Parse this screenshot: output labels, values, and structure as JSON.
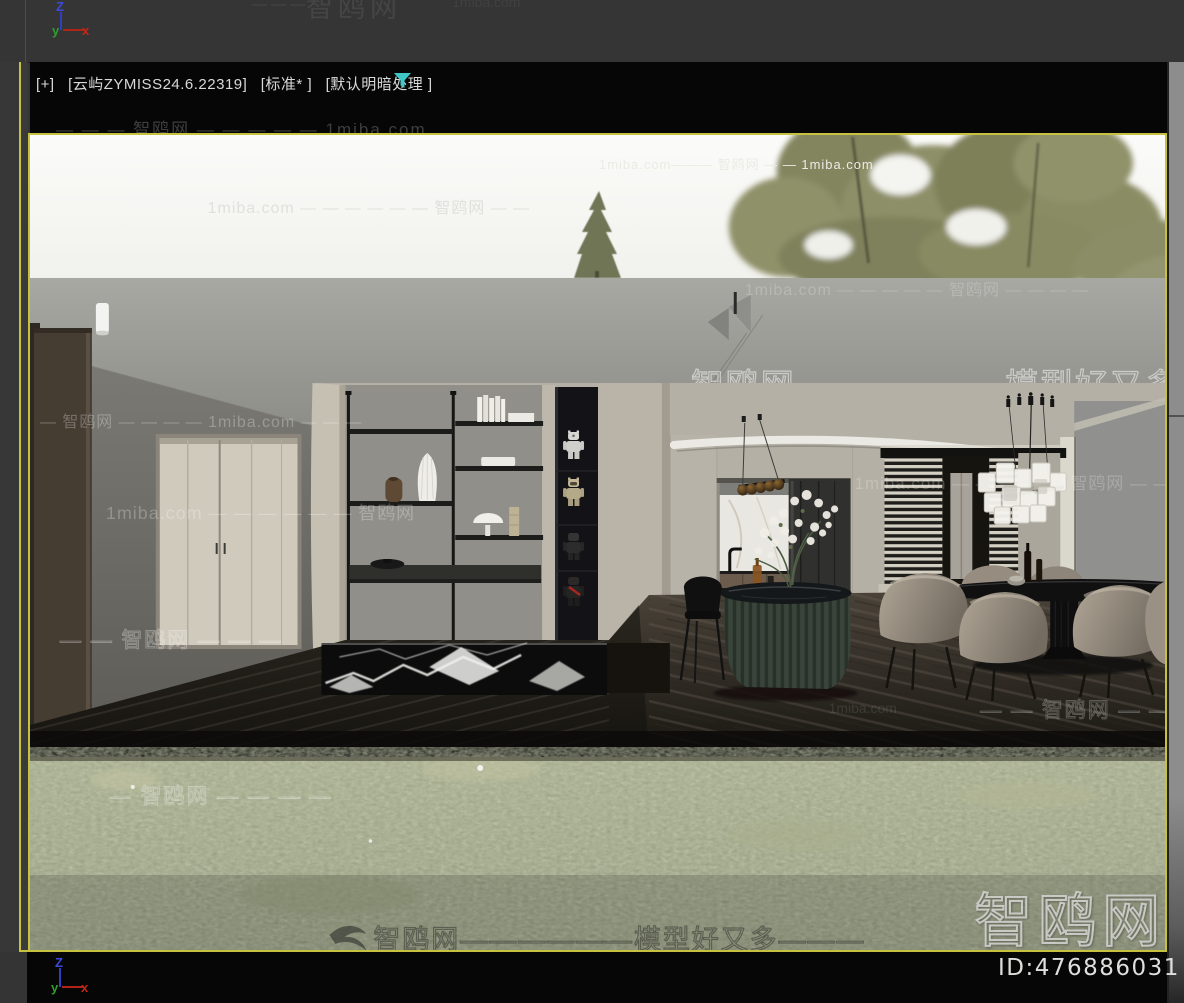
{
  "chrome": {
    "viewport_label": {
      "pov": "[+]",
      "name": "[云屿ZYMISS24.6.22319]",
      "style": "[标准* ]",
      "shading": "[默认明暗处理 ]"
    },
    "id_badge": "ID:476886031",
    "accent_border": "#c8c341",
    "filter_icon_color": "#3fc6c6",
    "top_axis": {
      "z": "Z",
      "y": "y",
      "x": "x"
    },
    "bottom_axis": {
      "z": "Z",
      "y": "y",
      "x": "x"
    },
    "axis_colors": {
      "z": "#4053e0",
      "y": "#3fae3f",
      "x": "#c23a2e"
    }
  },
  "watermarks": {
    "top_partial": "智鸥网",
    "top_dashes": "— — —",
    "top_site": "1miba.com",
    "bar": "— — — 智鸥网 — — — — — 1miba.com",
    "sky1": "1miba.com — — — — — — 智鸥网 — —",
    "sky2": "1miba.com——— 智鸥网 — — 1miba.com",
    "ceiling_right": "1miba.com — — — — — 智鸥网 — — — —",
    "ceiling_big": "智鸥网——————模型好又多———",
    "wall_left_1": "— 智鸥网 — — — — 1miba.com — — —",
    "wall_left_2": "1miba.com — — — — — — 智鸥网",
    "wall_left_3": "— — 智鸥网 — — —",
    "wall_right": "1miba.com — — — — — 智鸥网 — — —",
    "floor_right": "— — 智鸥网 — — — —",
    "floor_left": "1miba.com",
    "grass_left": "— 智鸥网 — — — —",
    "grass_big": "智鸥网",
    "grass_row": "智鸥网——————模型好又多———"
  }
}
